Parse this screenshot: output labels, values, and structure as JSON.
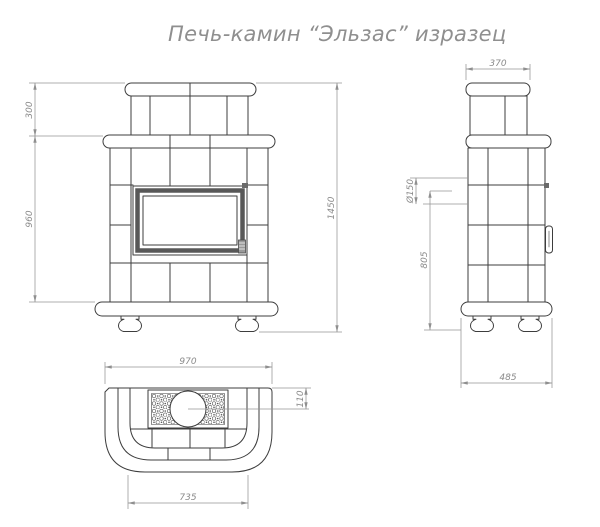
{
  "title": "Печь-камин “Эльзас” изразец",
  "drawing": {
    "front_view": {
      "dims": {
        "upper_height": "300",
        "body_height": "960",
        "total_height": "1450"
      }
    },
    "side_view": {
      "dims": {
        "top_depth": "370",
        "flue_diameter": "Ø150",
        "flue_center_height": "805",
        "base_depth": "485"
      }
    },
    "top_view": {
      "dims": {
        "total_width": "970",
        "flue_center_offset": "110",
        "front_width": "735"
      }
    }
  },
  "colors": {
    "object_line": "#3d3d3d",
    "dimension_line": "#949494",
    "text": "#8a8a8a",
    "background": "#ffffff"
  }
}
